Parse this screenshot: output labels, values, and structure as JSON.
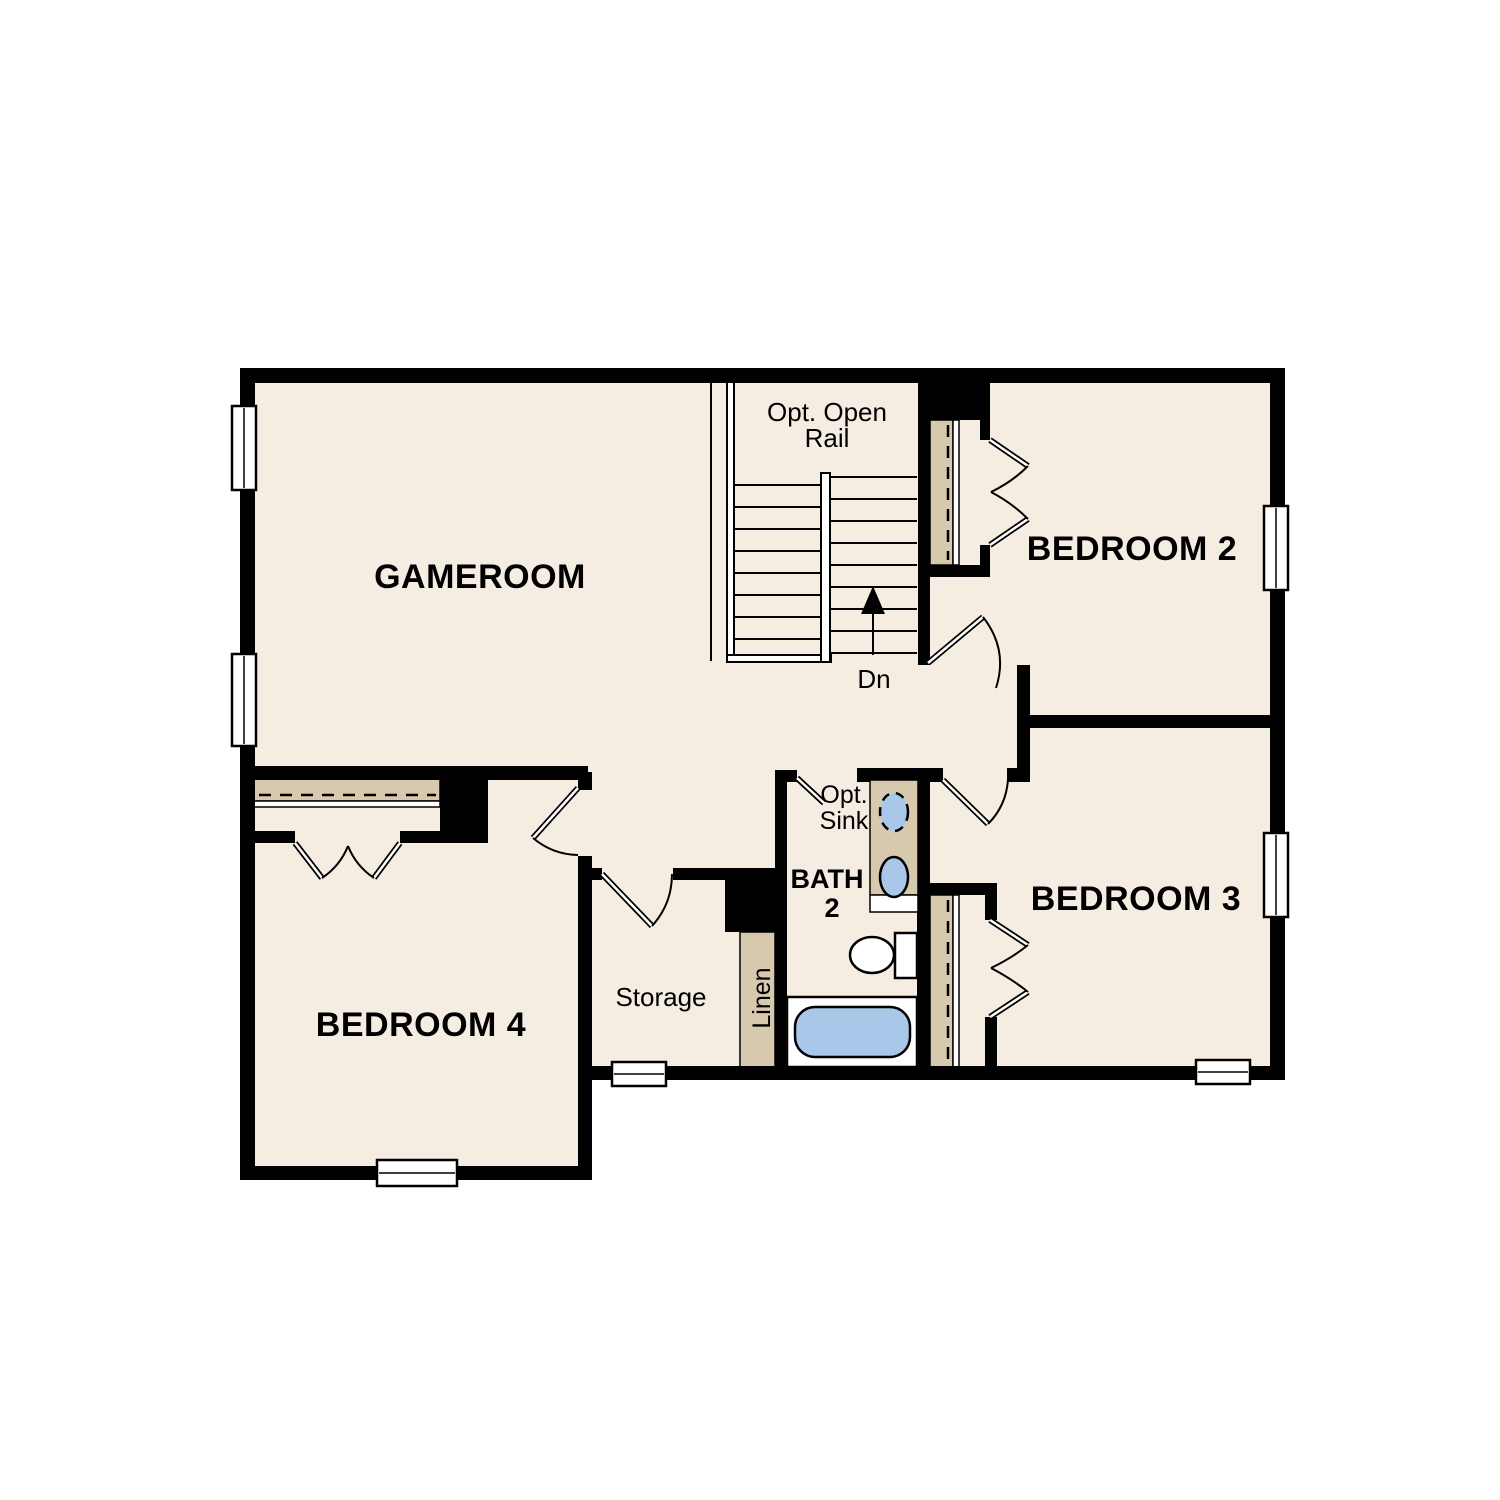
{
  "title": "Second Floor Plan",
  "colors": {
    "background": "#ffffff",
    "floor": "#f5ede2",
    "wall": "#000000",
    "shelf": "#d6c9ae",
    "fixture": "#a9c7e8",
    "line": "#000000"
  },
  "rooms": {
    "gameroom": "GAMEROOM",
    "bedroom2": "BEDROOM 2",
    "bedroom3": "BEDROOM 3",
    "bedroom4": "BEDROOM 4",
    "storage": "Storage",
    "linen": "Linen",
    "bath_line1": "BATH",
    "bath_line2": "2"
  },
  "annotations": {
    "open_rail_line1": "Opt. Open",
    "open_rail_line2": "Rail",
    "opt_sink_line1": "Opt.",
    "opt_sink_line2": "Sink",
    "stair_direction": "Dn"
  }
}
